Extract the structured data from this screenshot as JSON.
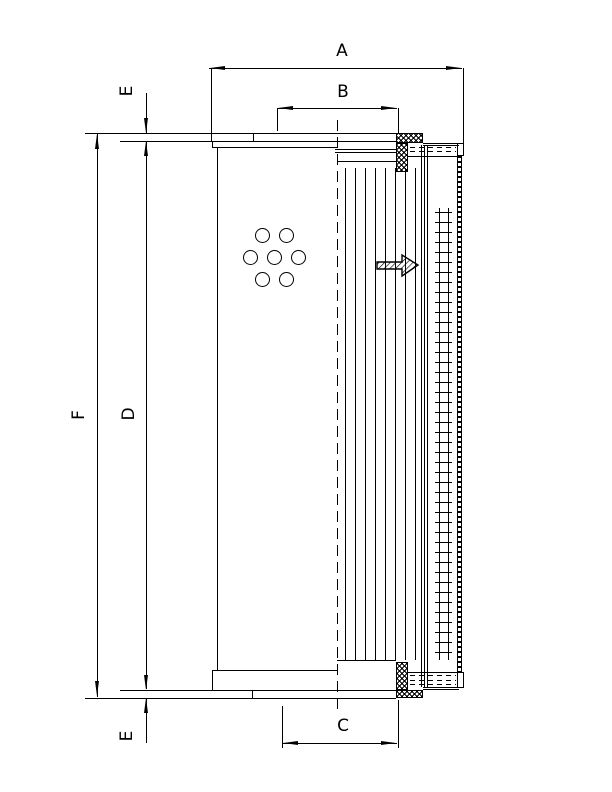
{
  "drawing": {
    "kind": "filter-element-technical-drawing",
    "colors": {
      "line": "#000000",
      "background": "#ffffff"
    },
    "dimension_labels": {
      "A": "A",
      "B": "B",
      "C": "C",
      "D": "D",
      "E_top": "E",
      "E_bottom": "E",
      "F": "F"
    },
    "flow_arrow": {
      "direction": "right"
    }
  }
}
